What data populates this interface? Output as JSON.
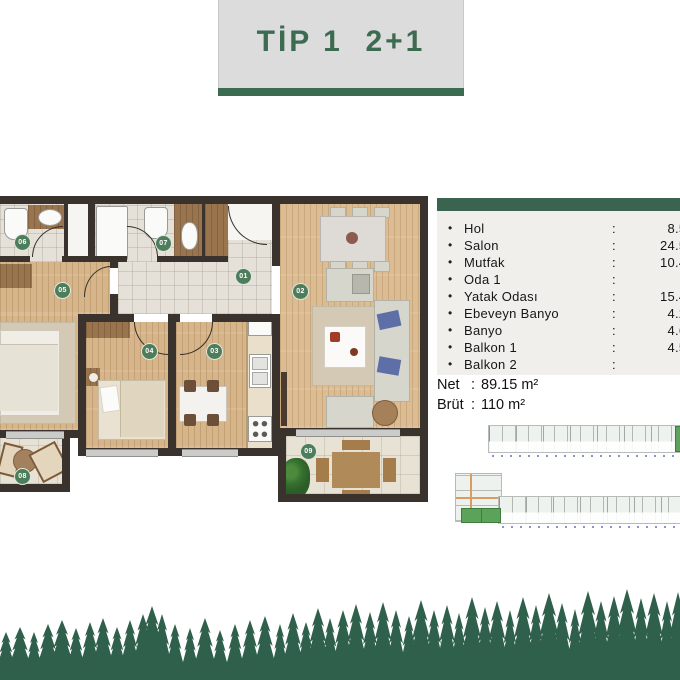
{
  "title": {
    "text": "TİP 1  2+1"
  },
  "floor_plan": {
    "badges": {
      "b01": "01",
      "b02": "02",
      "b03": "03",
      "b04": "04",
      "b05": "05",
      "b06": "06",
      "b07": "07",
      "b08": "08",
      "b09": "09"
    }
  },
  "room_table": {
    "bullet": "•",
    "colon": ":",
    "rows": [
      {
        "name": "Hol",
        "value": "8.50"
      },
      {
        "name": "Salon",
        "value": "24.50"
      },
      {
        "name": "Mutfak",
        "value": "10.40"
      },
      {
        "name": "Oda 1",
        "value": "10"
      },
      {
        "name": "Yatak Odası",
        "value": "15.40"
      },
      {
        "name": "Ebeveyn Banyo",
        "value": "4.20"
      },
      {
        "name": "Banyo",
        "value": "4.60"
      },
      {
        "name": "Balkon 1",
        "value": "4.50"
      },
      {
        "name": "Balkon 2",
        "value": ""
      }
    ]
  },
  "area": {
    "net_label": "Net",
    "net_colon": ":",
    "net_value": "89.15 m²",
    "brut_label": "Brüt",
    "brut_colon": ":",
    "brut_value": "110 m²"
  },
  "colors": {
    "accent_green": "#3b6b51",
    "badge_green": "#4e7d5b",
    "forest_green": "#2f604b",
    "wall_dark": "#3a322c",
    "wood_floor": "#d7b58a",
    "tile_floor": "#e6e1d8",
    "title_bg": "#dcdcdc",
    "table_bg": "#f0efec",
    "site_highlight": "#5ba25b"
  }
}
